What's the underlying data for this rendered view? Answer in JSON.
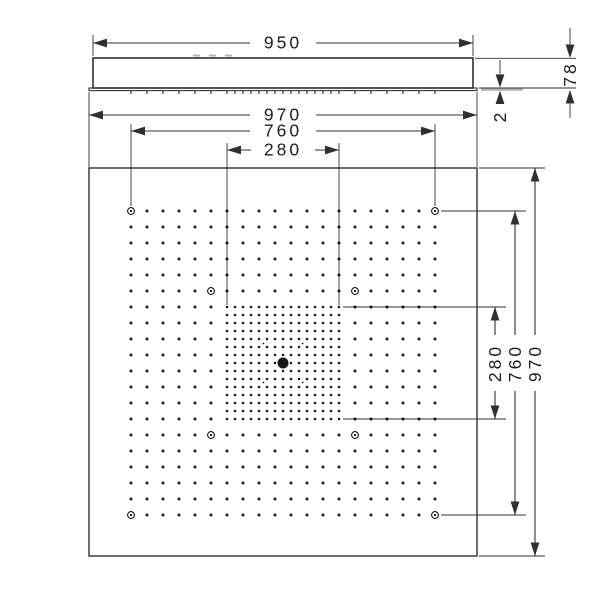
{
  "drawing": {
    "side_view": {
      "dim_top_width": "950",
      "dim_overall_width": "970",
      "dim_height": "78",
      "dim_plate_edge": "2"
    },
    "plan_view": {
      "dim_width_outer": "970",
      "dim_width_mount": "760",
      "dim_width_center": "280",
      "dim_height_outer": "970",
      "dim_height_mount": "760",
      "dim_height_center": "280"
    }
  },
  "colors": {
    "line": "#303030",
    "dot": "#161616",
    "gray_edge": "#b4b4b4",
    "faint_mark": "#8f8f8f",
    "text": "#1c1c1c",
    "background": "#ffffff"
  },
  "nozzle_pattern": {
    "outer_grid": {
      "cols": 20,
      "rows": 20,
      "pitch": 16,
      "x0": 131,
      "y0": 211,
      "dot_radius": 1.5
    },
    "dense_grid": {
      "cols": 15,
      "rows": 15,
      "pitch": 8,
      "x0": 227,
      "y0": 307,
      "dot_radius": 1.25
    },
    "screw_rings": {
      "cells": [
        [
          0,
          0
        ],
        [
          19,
          0
        ],
        [
          0,
          19
        ],
        [
          19,
          19
        ],
        [
          5,
          5
        ],
        [
          14,
          5
        ],
        [
          5,
          14
        ],
        [
          14,
          14
        ]
      ],
      "outer_radius": 3.4,
      "center_radius": 1.15
    },
    "center_outlet": {
      "x": 283,
      "y": 363,
      "radius": 5.5
    },
    "micro_jets": {
      "radius": 0.9,
      "points": [
        [
          263.5,
          343.5
        ],
        [
          302.5,
          343.5
        ],
        [
          263.5,
          382.5
        ],
        [
          302.5,
          382.5
        ]
      ]
    },
    "underside_ticks": {
      "y": 91.2,
      "height": 2.6,
      "width": 1.2
    },
    "top_marks": {
      "y": 54.5,
      "height": 2,
      "width": 7,
      "xs": [
        193,
        209,
        225
      ]
    }
  }
}
